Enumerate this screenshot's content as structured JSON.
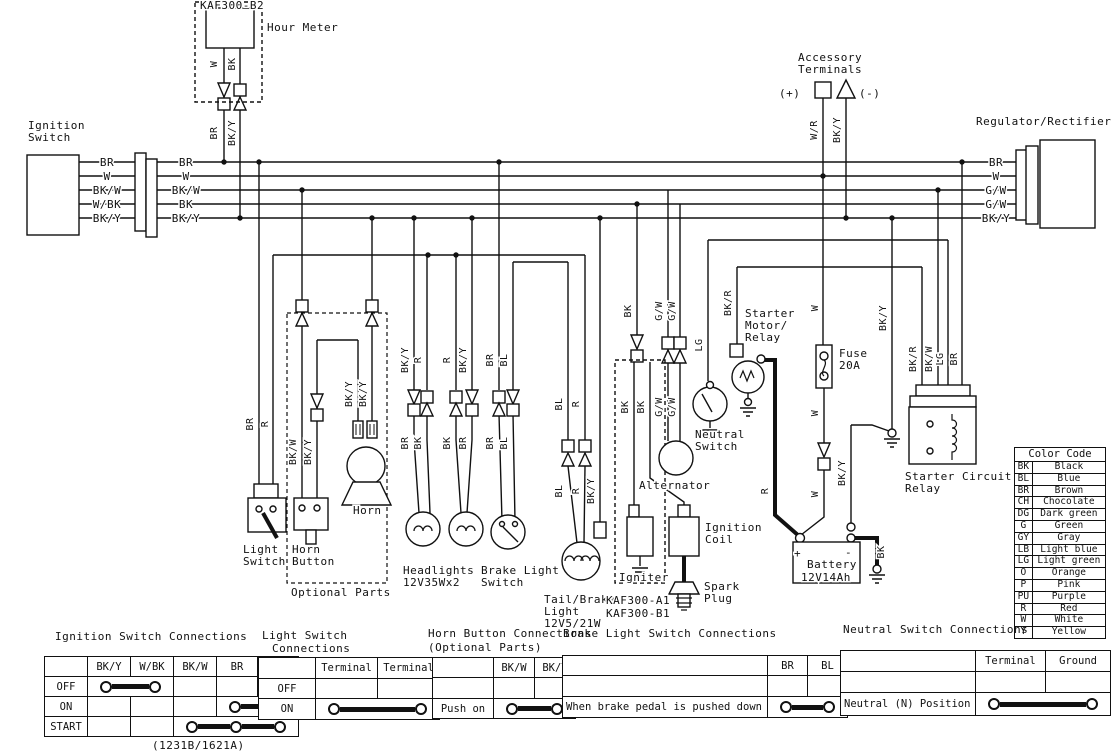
{
  "schematic": {
    "texts": [
      {
        "t": "KAF300-B2",
        "x": 200,
        "y": 9,
        "n": "hour-meter-model-label"
      },
      {
        "t": "Hour Meter",
        "x": 267,
        "y": 31,
        "n": "hour-meter-label"
      },
      {
        "t": "Ignition",
        "x": 28,
        "y": 129,
        "n": "ignition-switch-label"
      },
      {
        "t": "Switch",
        "x": 28,
        "y": 141,
        "n": "ignition-switch-label"
      },
      {
        "t": "Accessory",
        "x": 798,
        "y": 61,
        "n": "accessory-terminals-label"
      },
      {
        "t": "Terminals",
        "x": 798,
        "y": 73,
        "n": "accessory-terminals-label"
      },
      {
        "t": "(+)",
        "x": 779,
        "y": 97,
        "n": "accessory-plus-label"
      },
      {
        "t": "(-)",
        "x": 859,
        "y": 97,
        "n": "accessory-minus-label"
      },
      {
        "t": "Regulator/Rectifier",
        "x": 976,
        "y": 125,
        "n": "regulator-rectifier-label"
      },
      {
        "t": "Light",
        "x": 243,
        "y": 553,
        "n": "light-switch-label"
      },
      {
        "t": "Switch",
        "x": 243,
        "y": 565,
        "n": "light-switch-label"
      },
      {
        "t": "Horn",
        "x": 292,
        "y": 553,
        "n": "horn-button-label"
      },
      {
        "t": "Button",
        "x": 292,
        "y": 565,
        "n": "horn-button-label"
      },
      {
        "t": "Horn",
        "x": 353,
        "y": 514,
        "n": "horn-label"
      },
      {
        "t": "Optional Parts",
        "x": 291,
        "y": 596,
        "n": "optional-parts-label"
      },
      {
        "t": "Headlights",
        "x": 403,
        "y": 574,
        "n": "headlights-label"
      },
      {
        "t": "12V35Wx2",
        "x": 403,
        "y": 586,
        "n": "headlights-rating-label"
      },
      {
        "t": "Brake Light",
        "x": 481,
        "y": 574,
        "n": "brake-light-switch-label"
      },
      {
        "t": "Switch",
        "x": 481,
        "y": 586,
        "n": "brake-light-switch-label"
      },
      {
        "t": "Tail/Brake",
        "x": 544,
        "y": 603,
        "n": "tail-brake-light-label"
      },
      {
        "t": "Light",
        "x": 544,
        "y": 615,
        "n": "tail-brake-light-label"
      },
      {
        "t": "12V5/21W",
        "x": 544,
        "y": 627,
        "n": "tail-brake-light-rating-label"
      },
      {
        "t": "Igniter",
        "x": 619,
        "y": 581,
        "n": "igniter-label"
      },
      {
        "t": "KAF300-A1",
        "x": 606,
        "y": 604,
        "n": "igniter-model-label"
      },
      {
        "t": "KAF300-B1",
        "x": 606,
        "y": 617,
        "n": "igniter-model-label"
      },
      {
        "t": "Ignition",
        "x": 705,
        "y": 531,
        "n": "ignition-coil-label"
      },
      {
        "t": "Coil",
        "x": 705,
        "y": 543,
        "n": "ignition-coil-label"
      },
      {
        "t": "Spark",
        "x": 704,
        "y": 590,
        "n": "spark-plug-label"
      },
      {
        "t": "Plug",
        "x": 704,
        "y": 602,
        "n": "spark-plug-label"
      },
      {
        "t": "Alternator",
        "x": 639,
        "y": 489,
        "n": "alternator-label"
      },
      {
        "t": "Neutral",
        "x": 695,
        "y": 438,
        "n": "neutral-switch-label"
      },
      {
        "t": "Switch",
        "x": 695,
        "y": 450,
        "n": "neutral-switch-label"
      },
      {
        "t": "Starter",
        "x": 745,
        "y": 317,
        "n": "starter-motor-relay-label"
      },
      {
        "t": "Motor/",
        "x": 745,
        "y": 329,
        "n": "starter-motor-relay-label"
      },
      {
        "t": "Relay",
        "x": 745,
        "y": 341,
        "n": "starter-motor-relay-label"
      },
      {
        "t": "Fuse",
        "x": 839,
        "y": 357,
        "n": "fuse-label"
      },
      {
        "t": "20A",
        "x": 839,
        "y": 369,
        "n": "fuse-rating-label"
      },
      {
        "t": "+",
        "x": 794,
        "y": 557,
        "s": 13,
        "n": "battery-plus-label"
      },
      {
        "t": "-",
        "x": 845,
        "y": 556,
        "s": 13,
        "n": "battery-minus-label"
      },
      {
        "t": "Battery",
        "x": 807,
        "y": 568,
        "n": "battery-label"
      },
      {
        "t": "12V14Ah",
        "x": 801,
        "y": 581,
        "n": "battery-rating-label"
      },
      {
        "t": "Starter Circuit",
        "x": 905,
        "y": 480,
        "n": "starter-circuit-relay-label"
      },
      {
        "t": "Relay",
        "x": 905,
        "y": 492,
        "n": "starter-circuit-relay-label"
      },
      {
        "t": "BR",
        "x": 107,
        "y": 166,
        "a": "middle"
      },
      {
        "t": "W",
        "x": 107,
        "y": 180,
        "a": "middle"
      },
      {
        "t": "BK/W",
        "x": 107,
        "y": 194,
        "a": "middle"
      },
      {
        "t": "W/BK",
        "x": 107,
        "y": 208,
        "a": "middle"
      },
      {
        "t": "BK/Y",
        "x": 107,
        "y": 222,
        "a": "middle"
      },
      {
        "t": "BR",
        "x": 186,
        "y": 166,
        "a": "middle"
      },
      {
        "t": "W",
        "x": 186,
        "y": 180,
        "a": "middle"
      },
      {
        "t": "BK/W",
        "x": 186,
        "y": 194,
        "a": "middle"
      },
      {
        "t": "BK",
        "x": 186,
        "y": 208,
        "a": "middle"
      },
      {
        "t": "BK/Y",
        "x": 186,
        "y": 222,
        "a": "middle"
      },
      {
        "t": "BR",
        "x": 996,
        "y": 166,
        "a": "middle"
      },
      {
        "t": "W",
        "x": 996,
        "y": 180,
        "a": "middle"
      },
      {
        "t": "G/W",
        "x": 996,
        "y": 194,
        "a": "middle"
      },
      {
        "t": "G/W",
        "x": 996,
        "y": 208,
        "a": "middle"
      },
      {
        "t": "BK/Y",
        "x": 996,
        "y": 222,
        "a": "middle"
      },
      {
        "t": "W",
        "x": 217,
        "y": 64,
        "r": 1
      },
      {
        "t": "BK",
        "x": 235,
        "y": 64,
        "r": 1
      },
      {
        "t": "BR",
        "x": 217,
        "y": 133,
        "r": 1
      },
      {
        "t": "BK/Y",
        "x": 235,
        "y": 133,
        "r": 1
      },
      {
        "t": "W/R",
        "x": 817,
        "y": 130,
        "r": 1
      },
      {
        "t": "BK/Y",
        "x": 840,
        "y": 130,
        "r": 1
      },
      {
        "t": "BR",
        "x": 253,
        "y": 424,
        "r": 1
      },
      {
        "t": "R",
        "x": 268,
        "y": 424,
        "r": 1
      },
      {
        "t": "BK/W",
        "x": 296,
        "y": 452,
        "r": 1
      },
      {
        "t": "BK/Y",
        "x": 311,
        "y": 452,
        "r": 1
      },
      {
        "t": "BK/Y",
        "x": 352,
        "y": 394,
        "r": 1
      },
      {
        "t": "BK/Y",
        "x": 366,
        "y": 394,
        "r": 1
      },
      {
        "t": "BK/Y",
        "x": 408,
        "y": 360,
        "r": 1
      },
      {
        "t": "R",
        "x": 421,
        "y": 360,
        "r": 1
      },
      {
        "t": "R",
        "x": 450,
        "y": 360,
        "r": 1
      },
      {
        "t": "BK/Y",
        "x": 466,
        "y": 360,
        "r": 1
      },
      {
        "t": "BR",
        "x": 493,
        "y": 360,
        "r": 1
      },
      {
        "t": "BL",
        "x": 507,
        "y": 360,
        "r": 1
      },
      {
        "t": "BR",
        "x": 408,
        "y": 443,
        "r": 1
      },
      {
        "t": "BK",
        "x": 421,
        "y": 443,
        "r": 1
      },
      {
        "t": "BK",
        "x": 450,
        "y": 443,
        "r": 1
      },
      {
        "t": "BR",
        "x": 466,
        "y": 443,
        "r": 1
      },
      {
        "t": "BR",
        "x": 493,
        "y": 443,
        "r": 1
      },
      {
        "t": "BL",
        "x": 507,
        "y": 443,
        "r": 1
      },
      {
        "t": "BL",
        "x": 562,
        "y": 404,
        "r": 1
      },
      {
        "t": "R",
        "x": 579,
        "y": 404,
        "r": 1
      },
      {
        "t": "BL",
        "x": 562,
        "y": 491,
        "r": 1
      },
      {
        "t": "R",
        "x": 579,
        "y": 491,
        "r": 1
      },
      {
        "t": "BK/Y",
        "x": 594,
        "y": 491,
        "r": 1
      },
      {
        "t": "BK",
        "x": 631,
        "y": 311,
        "r": 1
      },
      {
        "t": "BK",
        "x": 628,
        "y": 407,
        "r": 1
      },
      {
        "t": "BK",
        "x": 644,
        "y": 407,
        "r": 1
      },
      {
        "t": "G/W",
        "x": 662,
        "y": 311,
        "r": 1
      },
      {
        "t": "G/W",
        "x": 675,
        "y": 311,
        "r": 1
      },
      {
        "t": "G/W",
        "x": 662,
        "y": 407,
        "r": 1
      },
      {
        "t": "G/W",
        "x": 675,
        "y": 407,
        "r": 1
      },
      {
        "t": "LG",
        "x": 702,
        "y": 345,
        "r": 1
      },
      {
        "t": "BK/R",
        "x": 731,
        "y": 303,
        "r": 1
      },
      {
        "t": "W",
        "x": 818,
        "y": 308,
        "r": 1
      },
      {
        "t": "W",
        "x": 818,
        "y": 413,
        "r": 1
      },
      {
        "t": "W",
        "x": 818,
        "y": 494,
        "r": 1
      },
      {
        "t": "R",
        "x": 768,
        "y": 491,
        "r": 1
      },
      {
        "t": "BK/Y",
        "x": 845,
        "y": 473,
        "r": 1
      },
      {
        "t": "BK/Y",
        "x": 886,
        "y": 318,
        "r": 1
      },
      {
        "t": "BK",
        "x": 884,
        "y": 552,
        "r": 1
      },
      {
        "t": "BK/R",
        "x": 916,
        "y": 359,
        "r": 1
      },
      {
        "t": "BK/W",
        "x": 932,
        "y": 359,
        "r": 1
      },
      {
        "t": "LG",
        "x": 943,
        "y": 359,
        "r": 1
      },
      {
        "t": "BR",
        "x": 957,
        "y": 359,
        "r": 1
      }
    ]
  },
  "color_code": {
    "title": "Color Code",
    "rows": [
      [
        "BK",
        "Black"
      ],
      [
        "BL",
        "Blue"
      ],
      [
        "BR",
        "Brown"
      ],
      [
        "CH",
        "Chocolate"
      ],
      [
        "DG",
        "Dark green"
      ],
      [
        "G",
        "Green"
      ],
      [
        "GY",
        "Gray"
      ],
      [
        "LB",
        "Light blue"
      ],
      [
        "LG",
        "Light green"
      ],
      [
        "O",
        "Orange"
      ],
      [
        "P",
        "Pink"
      ],
      [
        "PU",
        "Purple"
      ],
      [
        "R",
        "Red"
      ],
      [
        "W",
        "White"
      ],
      [
        "Y",
        "Yellow"
      ]
    ]
  },
  "tables": {
    "ignition": {
      "title": "Ignition Switch Connections",
      "headers": [
        "",
        "BK/Y",
        "W/BK",
        "BK/W",
        "BR",
        "W"
      ],
      "rows": [
        {
          "label": "OFF"
        },
        {
          "label": "ON"
        },
        {
          "label": "START"
        }
      ],
      "caption": "(1231B/1621A)"
    },
    "light": {
      "title_1": "Light Switch",
      "title_2": "Connections",
      "headers": [
        "",
        "Terminal",
        "Terminal"
      ],
      "rows": [
        {
          "label": "OFF"
        },
        {
          "label": "ON"
        }
      ]
    },
    "horn": {
      "title": "Horn Button Connections",
      "subtitle": "(Optional Parts)",
      "headers": [
        "",
        "BK/W",
        "BK/Y"
      ],
      "rows": [
        {
          "label": ""
        },
        {
          "label": "Push on"
        }
      ]
    },
    "brake": {
      "title": "Brake Light Switch Connections",
      "headers": [
        "",
        "BR",
        "BL"
      ],
      "rows": [
        {
          "label": ""
        },
        {
          "label": "When brake pedal is pushed down"
        }
      ]
    },
    "neutral": {
      "title": "Neutral Switch Connections",
      "headers": [
        "",
        "Terminal",
        "Ground"
      ],
      "rows": [
        {
          "label": ""
        },
        {
          "label": "Neutral (N) Position"
        }
      ]
    }
  }
}
